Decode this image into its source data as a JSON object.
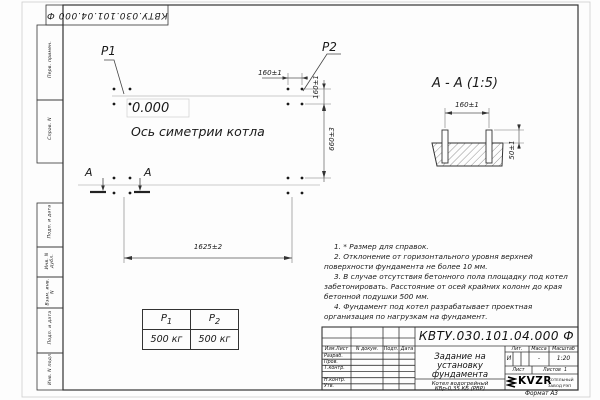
{
  "corner_stamp": {
    "doc_number": "КВТУ.030.101.04.000 Ф"
  },
  "left_strips": {
    "items": [
      "Перв. примен.",
      "Справ. N",
      "Подп. и дата",
      "Инв. N дубл.",
      "Взам. инв. N",
      "Подп. и дата",
      "Инв. N подл."
    ]
  },
  "plan": {
    "p1_label": "P1",
    "p2_label": "P2",
    "level_mark": "0.000",
    "axis_label": "Ось симетрии котла",
    "dim_width": "1625±2",
    "dim_height": "660±3",
    "dim_bolt_h": "160±1",
    "dim_bolt_v": "160±1",
    "section_letter_left": "А",
    "section_letter_right": "А"
  },
  "section": {
    "title": "А - А (1:5)",
    "dim_spacing": "160±1",
    "dim_height": "50±1"
  },
  "loads_table": {
    "col1": {
      "sym": "P",
      "sub": "1"
    },
    "col2": {
      "sym": "P",
      "sub": "2"
    },
    "value1": "500 кг",
    "value2": "500 кг"
  },
  "notes": [
    "1. * Размер для справок.",
    "2. Отклонение от горизонтального уровня верхней поверхности фундамента не более 10 мм.",
    "3. В случае отсутствия бетонного пола площадку под котел забетонировать. Расстояние от осей крайних колонн до края бетонной подушки 500 мм.",
    "4. Фундамент под котел разрабатывает проектная организация по нагрузкам на фундамент."
  ],
  "title_block": {
    "doc_number": "КВТУ.030.101.04.000  Ф",
    "title_lines": [
      "Задание на",
      "установку",
      "фундамента"
    ],
    "columns": [
      "Изм.Лист",
      "N докум.",
      "Подп.",
      "Дата"
    ],
    "rows": [
      "Разраб.",
      "Пров.",
      "Т.контр.",
      "Н.контр.",
      "Утв."
    ],
    "lit_header": "Лит.",
    "mass_header": "Масса",
    "scale_header": "Масштаб",
    "lit_value": "И",
    "mass_value": "-",
    "scale_value": "1:20",
    "sheet_label": "Лист",
    "sheets_label": "Листов",
    "sheets_value": "1",
    "product_lines": [
      "Котел водогрейный",
      "КВр-0,35 КБ  (РВР)"
    ],
    "company_logo": "KVZR",
    "company_name_lines": [
      "КОТЕЛЬНЫЙ",
      "ЗАВОД РЭП"
    ],
    "format_label": "Формат А3"
  }
}
